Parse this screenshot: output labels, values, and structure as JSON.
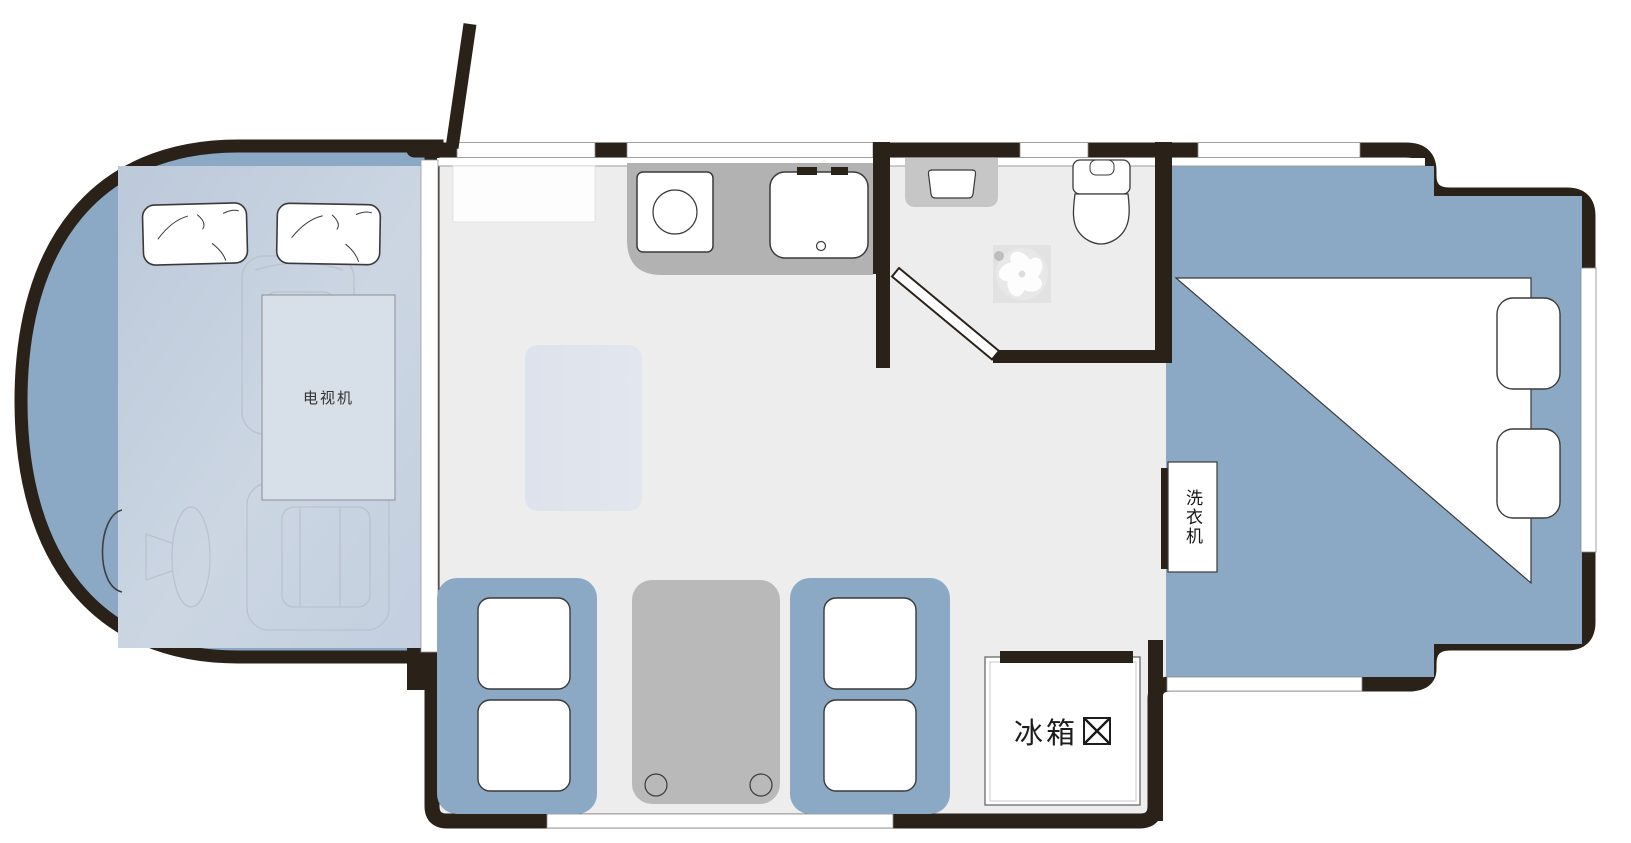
{
  "title": "RV motorhome floor plan",
  "labels": {
    "tv": "电视机",
    "washing_machine": "洗衣机",
    "refrigerator": "冰箱",
    "refrigerator_symbol": "⊠"
  },
  "colors": {
    "wall": "#2a2119",
    "blue": "#8ba9c4",
    "floor": "#ededed",
    "counter": "#b2b2b2",
    "table": "#b9b9b9",
    "rug": "#dfe4ee",
    "panel_light": "#c7d2e1"
  },
  "fixtures": [
    "cab-bunk-pillows",
    "tv-cabinet",
    "passenger-seat",
    "driver-seat",
    "steering-wheel",
    "entry-door",
    "overhead-cabinet",
    "kitchen-counter",
    "stove",
    "kitchen-sink",
    "bathroom-vanity",
    "toilet",
    "vent-fan",
    "bathroom-door",
    "floor-rug",
    "dinette-seats",
    "dinette-table",
    "refrigerator",
    "washing-machine",
    "bed",
    "bed-pillows",
    "windows"
  ]
}
